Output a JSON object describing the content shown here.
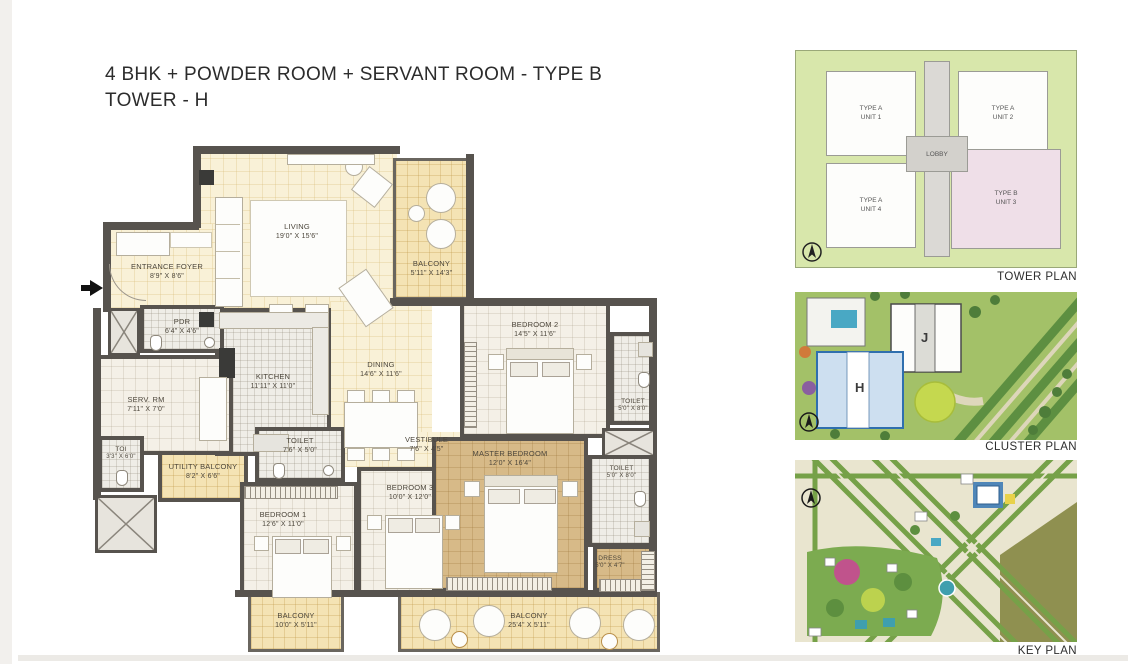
{
  "title": {
    "line1": "4 BHK + POWDER ROOM + SERVANT ROOM - TYPE B",
    "line2": "TOWER - H"
  },
  "floorplan": {
    "rooms": [
      {
        "label": "LIVING",
        "dims": "19'0\" X 15'6\""
      },
      {
        "label": "BALCONY",
        "dims": "5'11\" X 14'3\""
      },
      {
        "label": "ENTRANCE FOYER",
        "dims": "8'9\" X 8'6\""
      },
      {
        "label": "PDR",
        "dims": "6'4\" X 4'6\""
      },
      {
        "label": "SERV. RM",
        "dims": "7'11\" X 7'0\""
      },
      {
        "label": "KITCHEN",
        "dims": "11'11\" X 11'0\""
      },
      {
        "label": "DINING",
        "dims": "14'6\" X 11'6\""
      },
      {
        "label": "BEDROOM 2",
        "dims": "14'5\" X 11'6\""
      },
      {
        "label": "TOILET",
        "dims": "5'0\" X 8'0\""
      },
      {
        "label": "MASTER BEDROOM",
        "dims": "12'0\" X 16'4\""
      },
      {
        "label": "TOILET",
        "dims": "5'0\" X 8'0\""
      },
      {
        "label": "DRESS",
        "dims": "5'0\" X 4'7\""
      },
      {
        "label": "VESTIBULE",
        "dims": "7'6\" X 4'5\""
      },
      {
        "label": "BEDROOM 3",
        "dims": "10'0\" X 12'0\""
      },
      {
        "label": "TOILET",
        "dims": "7'6\" X 5'0\""
      },
      {
        "label": "BEDROOM 1",
        "dims": "12'6\" X 11'0\""
      },
      {
        "label": "UTILITY BALCONY",
        "dims": "8'2\" X 6'6\""
      },
      {
        "label": "TOI",
        "dims": "3'3\" X 6'0\""
      },
      {
        "label": "BALCONY",
        "dims": "10'0\" X 5'11\""
      },
      {
        "label": "BALCONY",
        "dims": "25'4\" X 5'11\""
      }
    ]
  },
  "tower_plan": {
    "caption": "TOWER PLAN",
    "lobby_label": "LOBBY",
    "units": [
      {
        "type": "TYPE A",
        "unit": "UNIT 1"
      },
      {
        "type": "TYPE A",
        "unit": "UNIT 2"
      },
      {
        "type": "TYPE A",
        "unit": "UNIT 4"
      },
      {
        "type": "TYPE B",
        "unit": "UNIT 3"
      }
    ]
  },
  "cluster_plan": {
    "caption": "CLUSTER PLAN",
    "tower_h_label": "H",
    "tower_j_label": "J"
  },
  "key_plan": {
    "caption": "KEY PLAN"
  },
  "colors": {
    "wall": "#57534e",
    "floor_cream": "#f9f1d7",
    "floor_balcony": "#f4e3b4",
    "floor_master": "#d7ba88",
    "tower_green": "#d8e7ab",
    "type_b_pink": "#efdfe8",
    "highlight_blue": "#2f6fae"
  }
}
